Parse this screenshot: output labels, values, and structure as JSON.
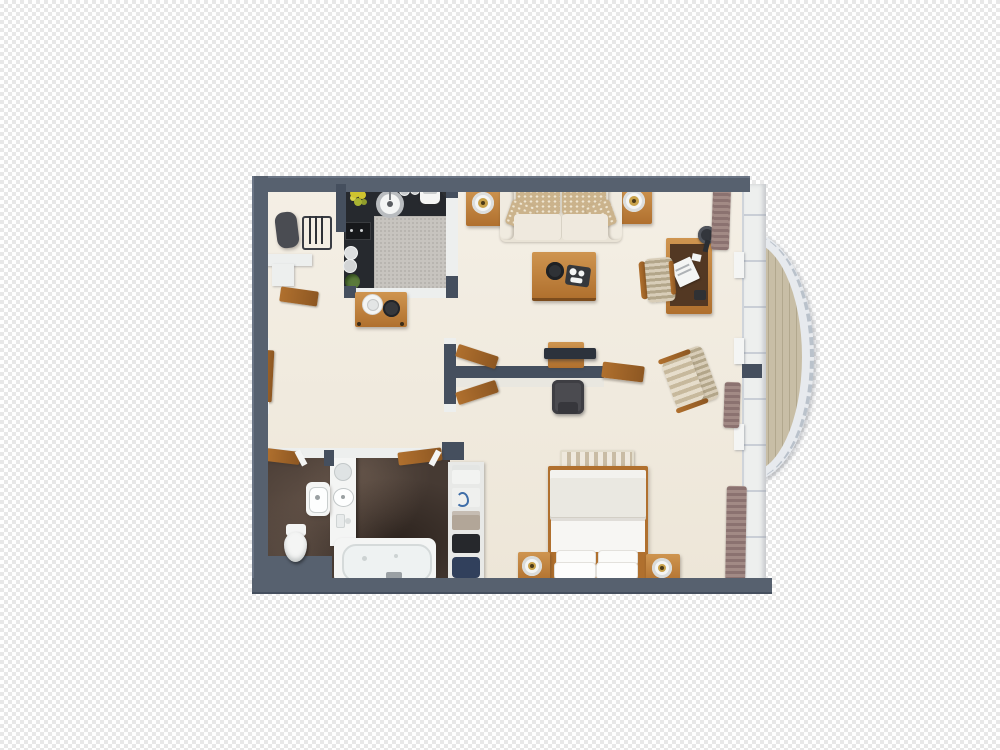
{
  "title": "3D floor plan rendering of a studio suite on a transparent checkerboard background",
  "colors": {
    "checker": "#e8e8e8",
    "checker-light": "#ffffff",
    "wall": "#57616f",
    "wall-dark": "#454f5e",
    "wall-light": "#6b7585",
    "white-wall": "#edefee",
    "floor": "#ede6d8",
    "floor-light": "#f4efe5",
    "kitchen-counter": "#26292e",
    "rug": "#c7c4bf",
    "rug-dot": "#b7b4af",
    "wood": "#b0702e",
    "wood-dark": "#8d5722",
    "wood-light": "#cf9550",
    "bath-floor": "#463a33",
    "fixture": "#f4f5f4",
    "deck": "#c8bea6",
    "deck-line": "#b2a88e",
    "railing": "#e7eaee",
    "curtain": "#8b7270",
    "curtain-light": "#a28a85",
    "sofa": "#e9e3d6",
    "sofa-light": "#f0ebe0",
    "pillow": "#cbb38c",
    "pillow-dot": "#efe6d2",
    "bed-ivory": "#eae8e1",
    "bed-white": "#f7f6f3",
    "bench-light": "#efe9dd",
    "bench-dark": "#c9bca4",
    "chair-stripe-a": "#d8cdb8",
    "chair-stripe-b": "#b3a68a",
    "tv-dark": "#2c323c",
    "media-chair": "#4b4b50",
    "desk-top": "#533823",
    "tray-dark": "#36383c",
    "shelf-taupe": "#b2a698",
    "shelf-black": "#26282c",
    "shelf-navy": "#31405c",
    "plant-green": "#5a7a3a",
    "flower-yellow": "#cfc42f",
    "lamp-gold": "#c9a24a",
    "metal": "#b9bcbf"
  },
  "scene": {
    "background": "transparency checkerboard",
    "labels": {
      "plan": "studio suite floor plan",
      "closet": "entry closet",
      "kitchen": "kitchenette",
      "living": "living room",
      "balcony": "curved balcony",
      "bathroom": "bathroom",
      "bedroom": "bedroom",
      "sofa": "sofa with patterned pillows",
      "coffee_table": "coffee table with bowl and tray",
      "end_table": "end table with lamp",
      "desk": "writing desk",
      "desk_chair": "desk chair",
      "armchair": "striped armchair",
      "tv": "tv on room divider",
      "media_bench": "luggage bench",
      "console": "hall console table",
      "bed": "double bed",
      "bed_bench": "foot-of-bed bench",
      "nightstand": "nightstand with lamp",
      "bathtub": "bathtub",
      "toilet": "toilet",
      "sink": "hand sink",
      "vanity": "vanity counter",
      "linen_shelf": "linen shelf with towels",
      "luggage": "suitcase",
      "valet": "luggage rack",
      "kitchen_sink": "round kitchen sink",
      "cooktop": "cooktop",
      "rug": "kitchen rug",
      "curtains": "drawn curtains",
      "window_wall": "window wall",
      "railing": "balcony railing",
      "deck": "balcony wood deck"
    },
    "rooms": [
      {
        "name": "closet",
        "items": [
          "suitcase",
          "luggage rack"
        ]
      },
      {
        "name": "kitchenette",
        "items": [
          "dark counter",
          "gray rug",
          "round sink",
          "cooktop",
          "plates",
          "flowers",
          "plant",
          "appliance"
        ]
      },
      {
        "name": "living room",
        "items": [
          "sofa",
          "4 patterned pillows",
          "2 end tables",
          "2 table lamps",
          "coffee table",
          "tv divider",
          "tv",
          "media bench",
          "console table",
          "desk",
          "desk lamp",
          "desk chair",
          "armchair"
        ]
      },
      {
        "name": "balcony",
        "items": [
          "curved white railing",
          "wood plank deck"
        ]
      },
      {
        "name": "bathroom",
        "items": [
          "bathtub",
          "toilet",
          "hand sink",
          "vanity",
          "towel",
          "linen shelf"
        ]
      },
      {
        "name": "bedroom",
        "items": [
          "double bed",
          "4 pillows",
          "striped bench",
          "2 nightstands",
          "2 bedside lamps",
          "curtains"
        ]
      }
    ]
  }
}
